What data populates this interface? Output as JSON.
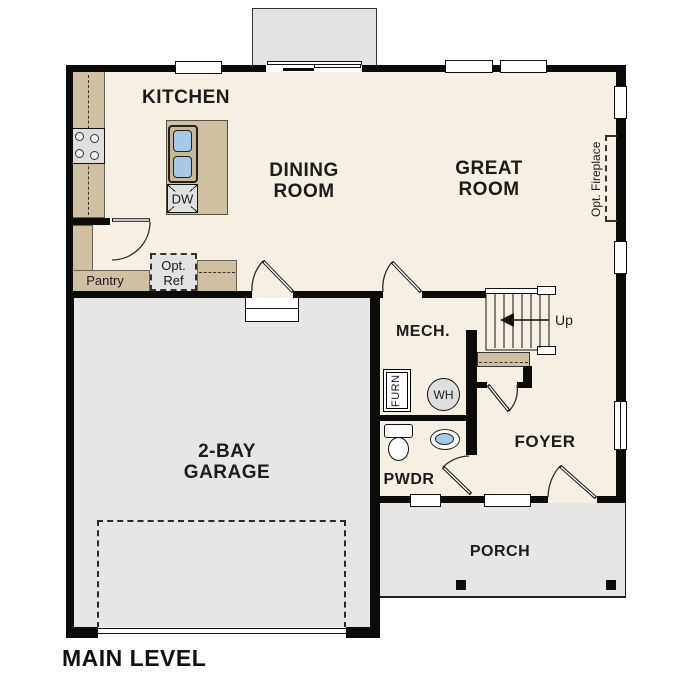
{
  "plan": {
    "title": "MAIN LEVEL",
    "rooms": {
      "kitchen": "KITCHEN",
      "dining": {
        "line1": "DINING",
        "line2": "ROOM"
      },
      "great": {
        "line1": "GREAT",
        "line2": "ROOM"
      },
      "garage": {
        "line1": "2-BAY",
        "line2": "GARAGE"
      },
      "mech": "MECH.",
      "foyer": "FOYER",
      "pwdr": "PWDR",
      "porch": "PORCH",
      "pantry": "Pantry"
    },
    "annotations": {
      "up": "Up",
      "dw": "DW",
      "wh": "WH",
      "furn": "FURN",
      "opt_ref": {
        "line1": "Opt.",
        "line2": "Ref"
      },
      "opt_fireplace": "Opt. Fireplace"
    },
    "colors": {
      "wall": "#0b0b0b",
      "interior_floor": "#f6efe3",
      "exterior_gray": "#e7e6e4",
      "counter_tan": "#cfc0a4",
      "sink_blue": "#a9c8e8",
      "appliance_gray": "#dedede"
    }
  }
}
